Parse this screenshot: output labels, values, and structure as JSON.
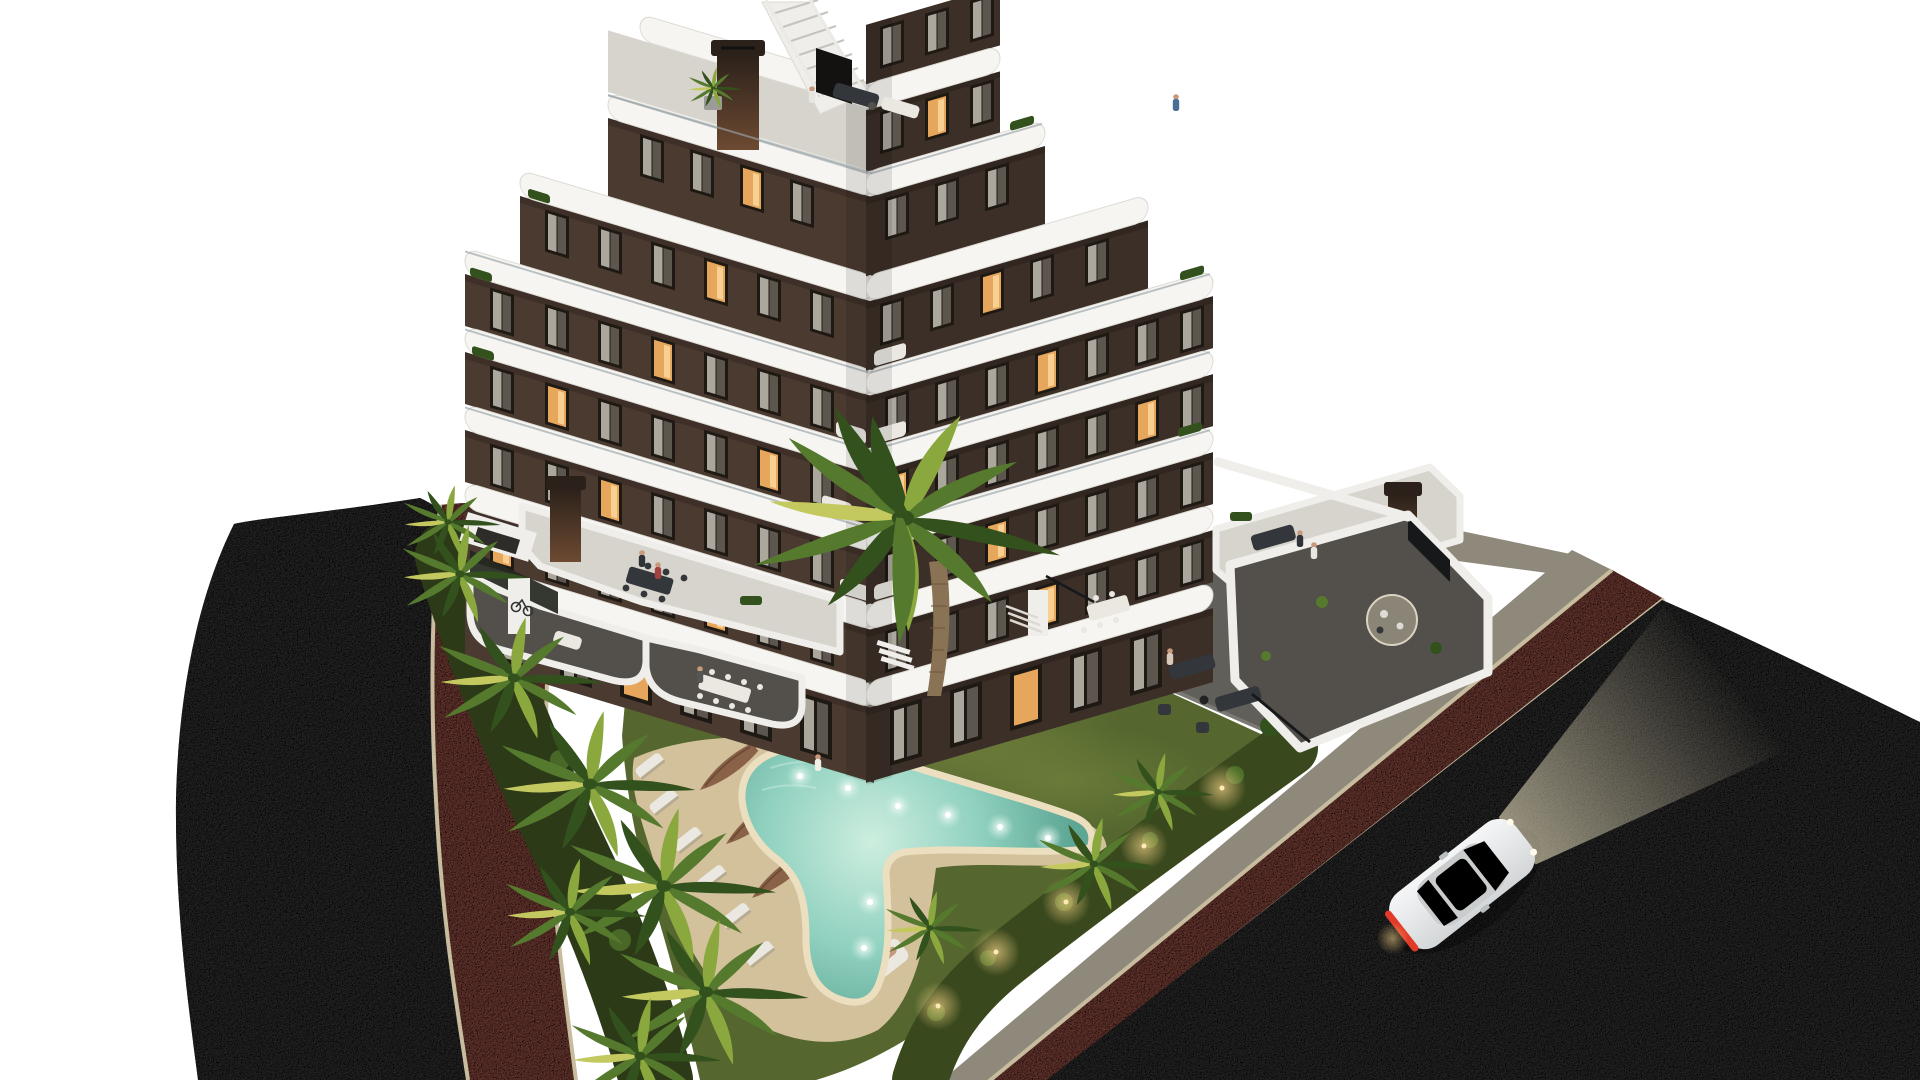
{
  "scene": {
    "title": "Aerial dusk rendering of a modern L-shaped apartment building with zigzag white balconies, garden, boomerang-shaped pool and surrounding roads",
    "type": "architectural-3d-render",
    "time_of_day": "dusk",
    "elements": [
      "apartment-building",
      "rooftop-terrace",
      "podium-terraces",
      "white-balcony-bands",
      "brown-facade-windows",
      "chimneys",
      "roof-stairs",
      "ground-floor-terraces",
      "courtyard",
      "garden-lawn",
      "gravel-planting-island",
      "large-palm-tree",
      "palm-tree-row",
      "swimming-pool",
      "pool-lights",
      "pool-deck",
      "sun-loungers",
      "closed-parasols",
      "pool-lamp",
      "boundary-hedge",
      "garden-uplights",
      "left-road",
      "left-bike-path",
      "right-road",
      "right-bike-path",
      "sidewalk",
      "white-sports-car",
      "pedestrians"
    ],
    "counts": {
      "visible_floors": 7,
      "pool_lights": 8,
      "sun_loungers": 6,
      "parasols": 3,
      "cars": 1
    }
  },
  "palette": {
    "bg": "#ffffff",
    "asphalt": "#3d3c3e",
    "red_path": "#94544b",
    "curb": "#c8bc9f",
    "sidewalk": "#8f897c",
    "lawn": "#55672f",
    "lawn_lit": "#7b8a41",
    "hedge": "#3a491d",
    "hedge_lit": "#69762f",
    "underbrush": "#2c3a17",
    "palm_green": "#557a2e",
    "palm_light": "#8aa83e",
    "palm_yellow": "#c3c95e",
    "palm_dark": "#33511d",
    "trunk": "#8a7254",
    "deck": "#d3c19c",
    "pool_rim": "#ecdfc0",
    "water_light": "#cdeedf",
    "water": "#8fd0bf",
    "water_deep": "#5fa795",
    "gravel": "#8b8577",
    "gravel_border": "#dad3c2",
    "pave": "#7b7973",
    "pave_light": "#8d8a84",
    "pave_dark": "#615f5a",
    "terrace_floor": "#53504b",
    "roof_floor": "#d7d4cd",
    "facade_left": "#4a3a30",
    "facade_right": "#3b2f27",
    "window_frame": "#1f1914",
    "curtain": "#b9b3a9",
    "curtain_dim": "#857f76",
    "lit_warm": "#e6a75d",
    "lit_bright": "#f7d092",
    "white_band": "#f6f5f2",
    "white_shade": "#dcdad3",
    "wall_white": "#efeeea",
    "chimney_dark": "#2b211a",
    "chimney_rust": "#6d4a32",
    "furn_white": "#eae8e1",
    "furn_dark": "#33363a",
    "steel": "#9aa3a6",
    "car_body": "#ebedee",
    "tail_red": "#e23a28",
    "beam": "#fff4d0",
    "glow": "#ffd98c",
    "skin": "#c9997d"
  }
}
